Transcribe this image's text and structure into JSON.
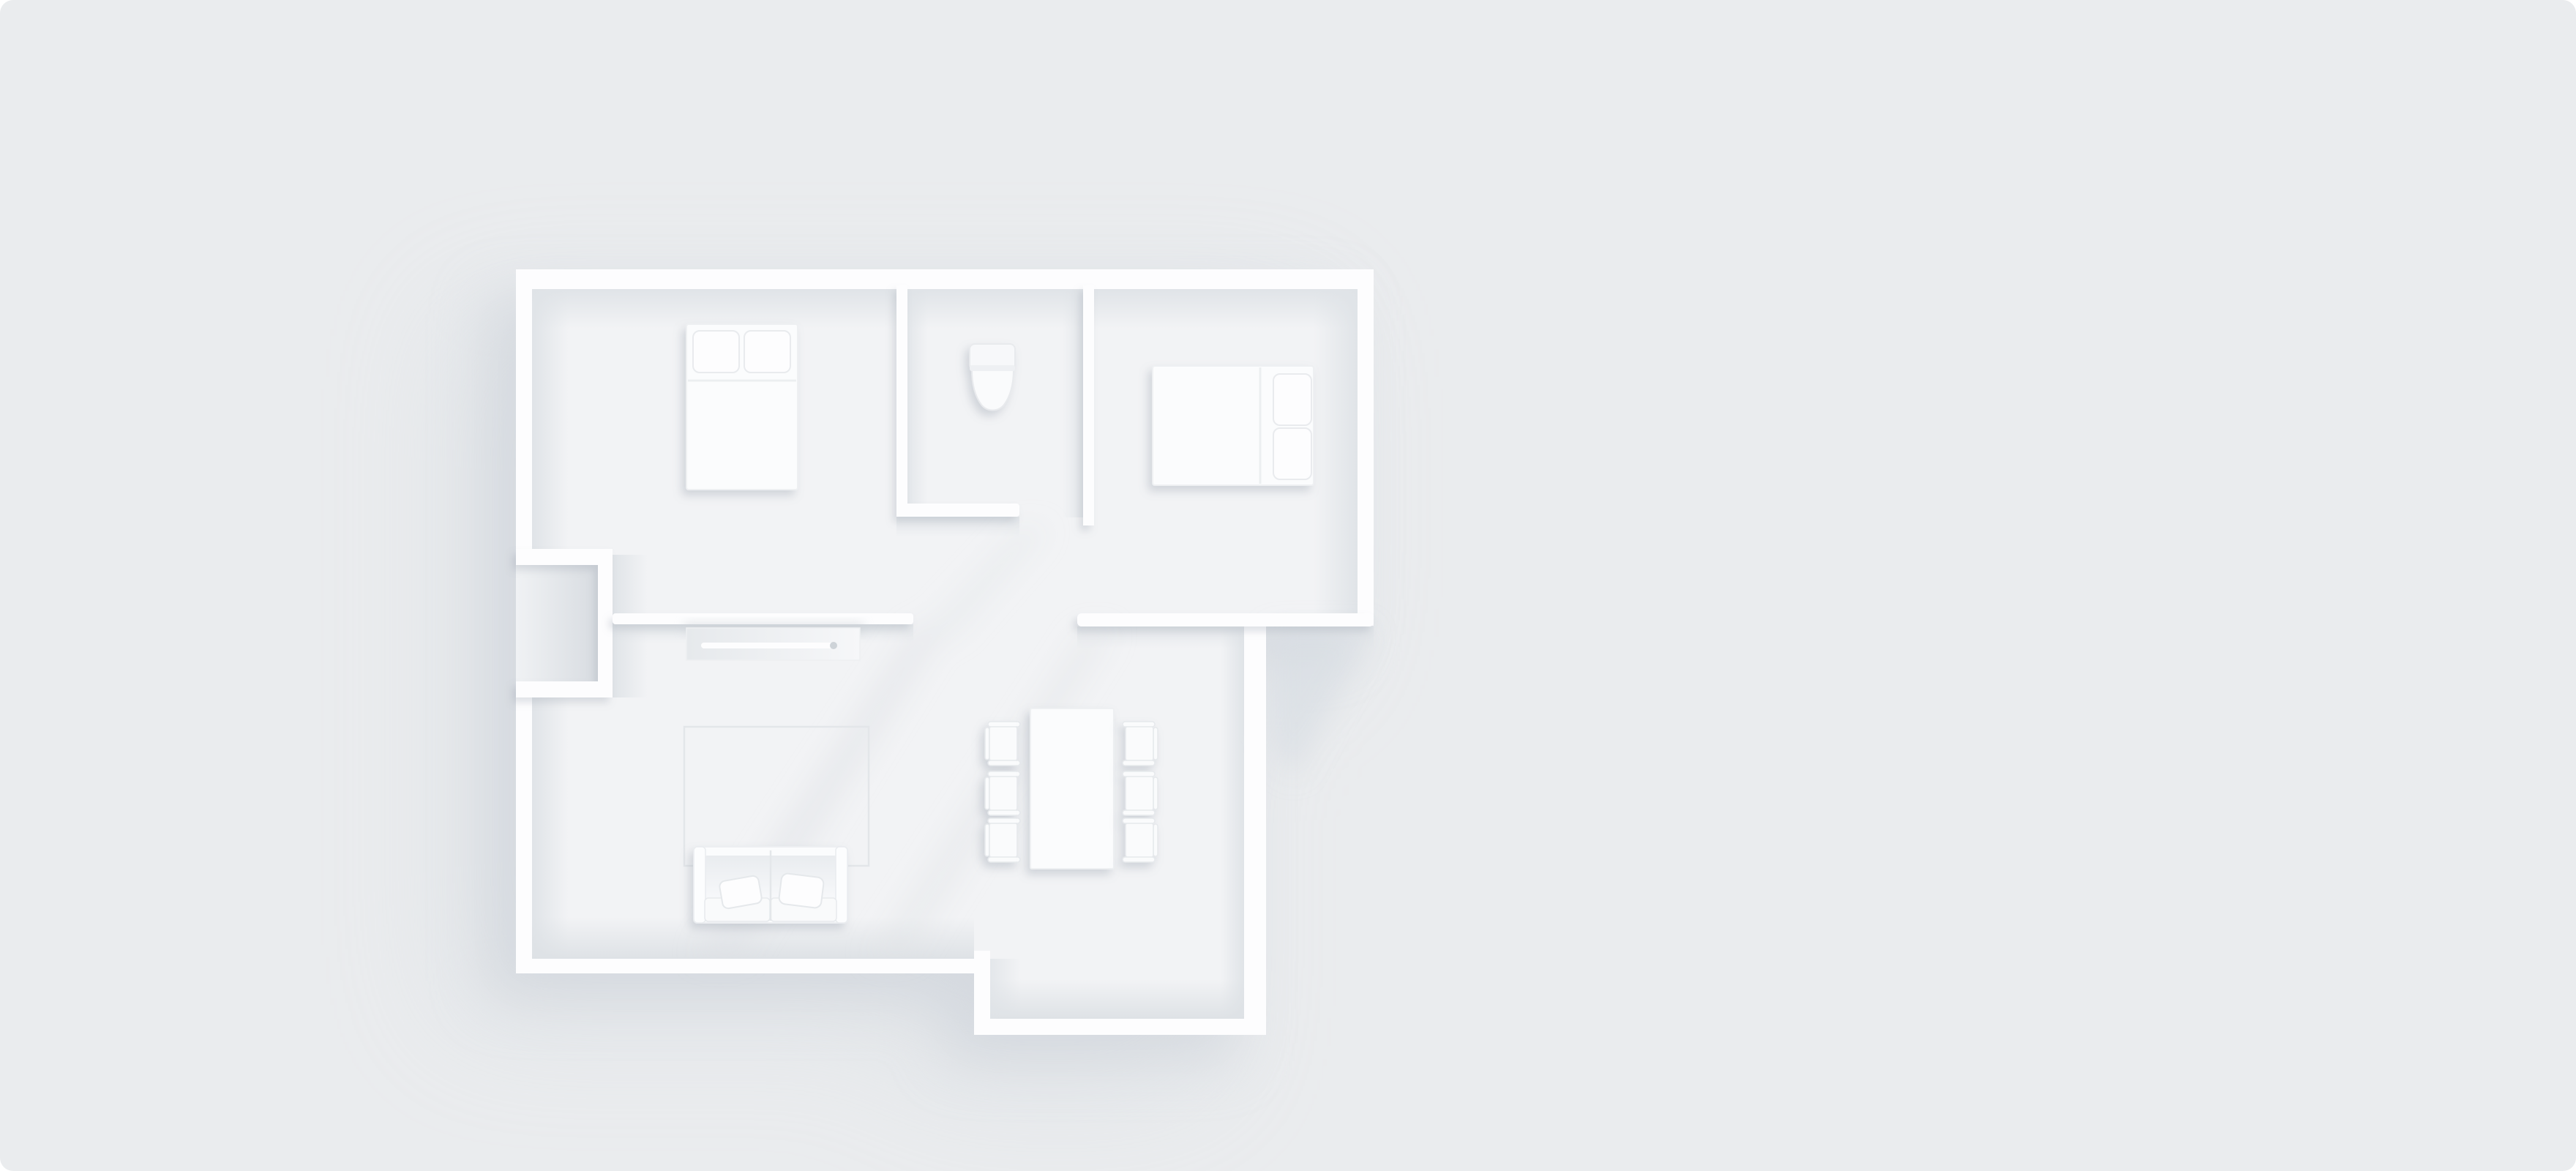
{
  "scene": {
    "title": "3D top-down floor plan render of an apartment",
    "style": "monochrome white architectural mockup, soft studio lighting, light from upper right",
    "rooms": [
      {
        "name": "bedroom-1",
        "position": "top-left",
        "furniture": [
          "double-bed",
          "pillow",
          "pillow"
        ]
      },
      {
        "name": "bathroom",
        "position": "top-middle",
        "furniture": [
          "toilet"
        ]
      },
      {
        "name": "bedroom-2",
        "position": "top-right",
        "furniture": [
          "double-bed",
          "pillow",
          "pillow"
        ]
      },
      {
        "name": "living-room",
        "position": "bottom-left",
        "furniture": [
          "tv-console",
          "rug",
          "sofa",
          "throw-pillow",
          "throw-pillow"
        ]
      },
      {
        "name": "dining-area",
        "position": "bottom-right",
        "furniture": [
          "dining-table",
          "chair",
          "chair",
          "chair",
          "chair",
          "chair",
          "chair"
        ]
      },
      {
        "name": "entry-vestibule",
        "position": "left-wall",
        "furniture": []
      }
    ],
    "counts": {
      "beds": 2,
      "sofas": 1,
      "dining_chairs": 6,
      "tables": 1,
      "toilets": 1
    },
    "colors": {
      "background": "#eaecee",
      "floor": "#f2f3f5",
      "wall_top": "#fdfdfe",
      "wall_inner_face": "#dfe3e7",
      "furniture": "#fbfcfd",
      "outline": "#e6e9ec",
      "shadow": "#c9cfd7"
    }
  }
}
